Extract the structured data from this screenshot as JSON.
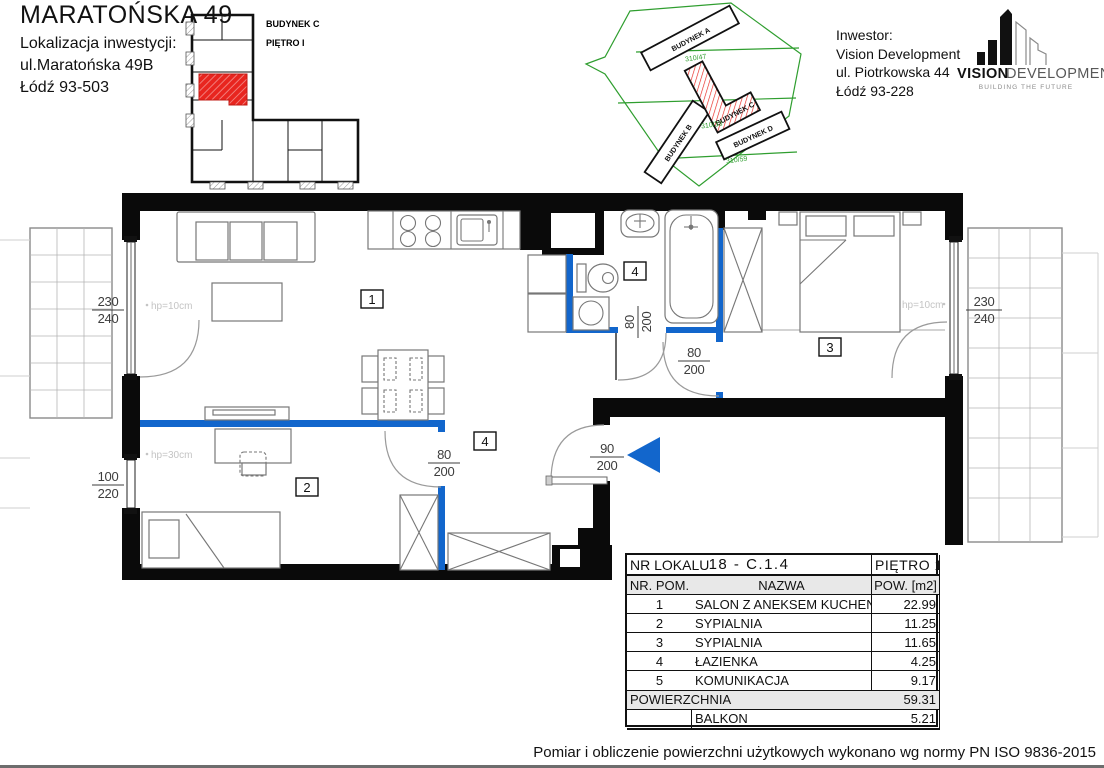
{
  "title_block": {
    "title": "MARATOŃSKA 49",
    "line1": "Lokalizacja inwestycji:",
    "line2": "ul.Maratońska 49B",
    "line3": "Łódź 93-503"
  },
  "unit_locator": {
    "building": "BUDYNEK C",
    "floor": "PIĘTRO I"
  },
  "site_plan": {
    "building_a": "BUDYNEK A",
    "building_b": "BUDYNEK B",
    "building_c": "BUDYNEK C",
    "building_d": "BUDYNEK D",
    "parcel_1": "310/47",
    "parcel_2": "310/33",
    "parcel_3": "310/59"
  },
  "investor": {
    "label": "Inwestor:",
    "name": "Vision Development",
    "street": "ul. Piotrkowska 44",
    "city": "Łódź 93-228"
  },
  "logo": {
    "brand_primary": "VISION",
    "brand_secondary": "DEVELOPMENT",
    "tagline": "BUILDING THE FUTURE"
  },
  "plan": {
    "room_tags": {
      "living": "1",
      "bedroom2": "2",
      "bedroom3": "3",
      "bathroom": "4",
      "hall": "4"
    },
    "dims": {
      "left_balcony_door": {
        "w": "230",
        "h": "240"
      },
      "left_window": {
        "w": "100",
        "h": "220"
      },
      "right_balcony_door": {
        "w": "230",
        "h": "240"
      },
      "entrance_door": {
        "w": "90",
        "h": "200"
      },
      "bedroom2_door": {
        "w": "80",
        "h": "200"
      },
      "bathroom_door": {
        "w": "80",
        "h": "200"
      },
      "bedroom3_door": {
        "w": "80",
        "h": "200"
      }
    },
    "notes": {
      "hp_living": "hp=10cm",
      "hp_bedroom2": "hp=30cm",
      "hp_bedroom3": "hp=10cm"
    }
  },
  "area_table": {
    "unit_label": "NR LOKALU",
    "unit_value": "18 - C.1.4",
    "floor_value": "PIĘTRO 1",
    "columns": [
      "NR. POM.",
      "NAZWA",
      "POW. [m2]"
    ],
    "rows": [
      [
        "1",
        "SALON Z ANEKSEM KUCHENNYM",
        "22.99"
      ],
      [
        "2",
        "SYPIALNIA",
        "11.25"
      ],
      [
        "3",
        "SYPIALNIA",
        "11.65"
      ],
      [
        "4",
        "ŁAZIENKA",
        "4.25"
      ],
      [
        "5",
        "KOMUNIKACJA",
        "9.17"
      ]
    ],
    "total_label": "POWIERZCHNIA",
    "total_value": "59.31",
    "extra_rows": [
      [
        "",
        "BALKON",
        "5.21"
      ],
      [
        "",
        "BALKON",
        "7.82"
      ]
    ]
  },
  "footer": {
    "note": "Pomiar i obliczenie powierzchni użytkowych wykonano wg normy PN ISO 9836-2015"
  },
  "colors": {
    "accent_red": "#e8251f",
    "wall_blue": "#1266cc",
    "site_green": "#2f9e2f",
    "wall_black": "#0a0a0a"
  }
}
